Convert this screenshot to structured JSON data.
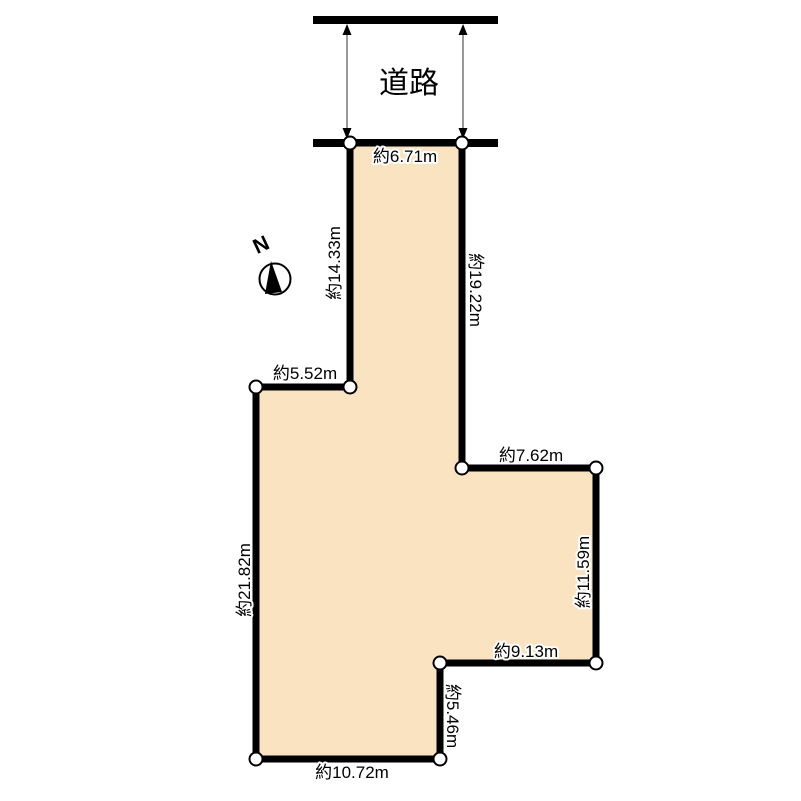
{
  "road": {
    "label": "道路",
    "edge_color": "#000000",
    "arrow_line_color": "#999999"
  },
  "compass": {
    "north_label": "N"
  },
  "plot": {
    "fill_color": "#fae3c1",
    "outline_color": "#000000",
    "edges": [
      {
        "name": "frontage-top",
        "length": "約6.71m"
      },
      {
        "name": "upper-strip-left",
        "length": "約14.33m"
      },
      {
        "name": "upper-strip-right",
        "length": "約19.22m"
      },
      {
        "name": "upper-notch-top",
        "length": "約5.52m"
      },
      {
        "name": "right-step-top",
        "length": "約7.62m"
      },
      {
        "name": "right-side",
        "length": "約11.59m"
      },
      {
        "name": "lower-step-top",
        "length": "約9.13m"
      },
      {
        "name": "lower-step-side",
        "length": "約5.46m"
      },
      {
        "name": "bottom",
        "length": "約10.72m"
      },
      {
        "name": "left-side",
        "length": "約21.82m"
      }
    ]
  }
}
